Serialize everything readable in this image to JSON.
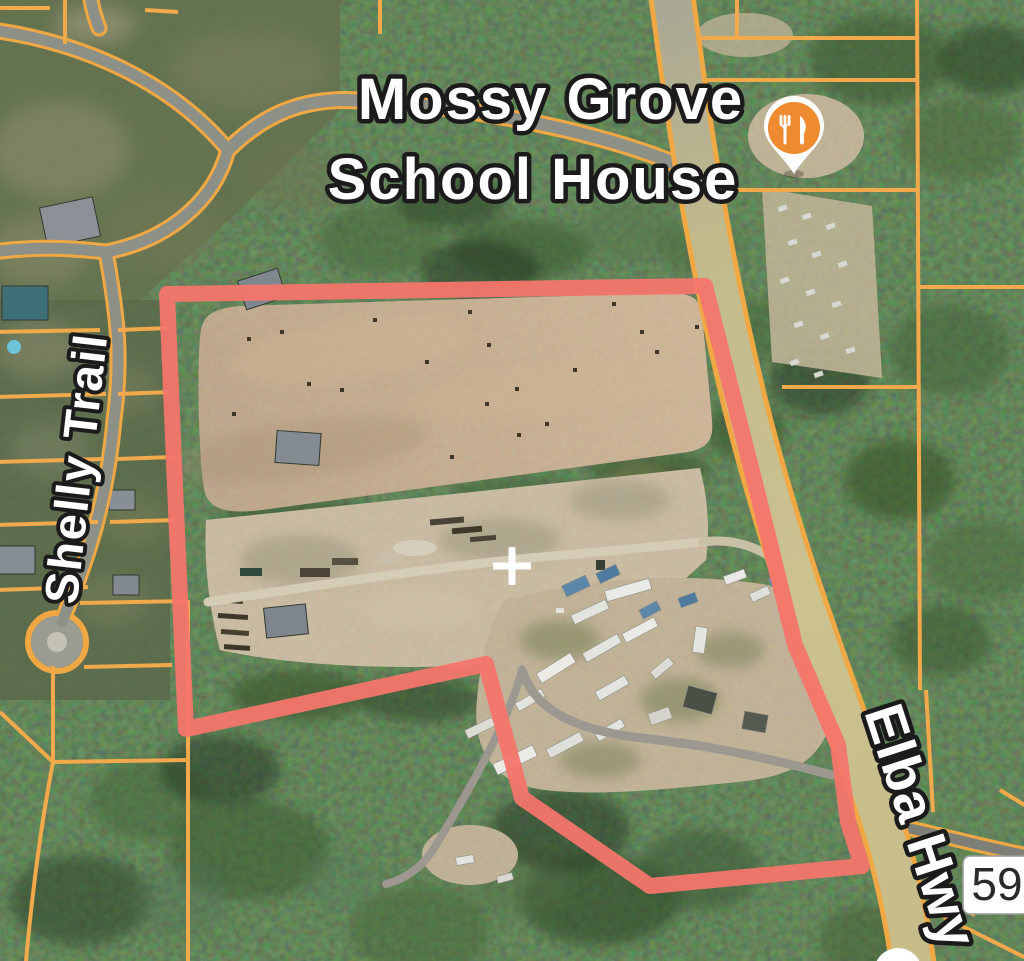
{
  "map": {
    "view_type": "satellite",
    "place_label": {
      "line1": "Mossy Grove",
      "line2": "School House"
    },
    "road_labels": {
      "shelly_trail": "Shelly Trail",
      "elba_hwy": "Elba Hwy"
    },
    "route_shield": {
      "number": "59"
    },
    "poi": {
      "name": "restaurant",
      "icon": "fork-knife-icon",
      "pin_color": "#EE8A30"
    },
    "overlay": {
      "parcel_boundary": {
        "color": "#F4756C",
        "stroke_width": 16,
        "points": "167,294 705,286 758,495 795,645 838,745 848,822 862,866 650,886 522,798 486,664 186,729 176,510"
      },
      "crosshair": {
        "color": "#FFFFFF"
      }
    },
    "palette": {
      "forest_green": "#33492B",
      "field_tan": "#BCA184",
      "road_casing_orange": "#F2A94C",
      "road_fill_gray": "#8D9086",
      "highway_fill": "#C9BF8E",
      "label_text": "#FFFFFF",
      "label_outline": "#1B1B1B",
      "shield_bg": "#FFFFFF",
      "shield_text": "#2A2A2A"
    }
  }
}
